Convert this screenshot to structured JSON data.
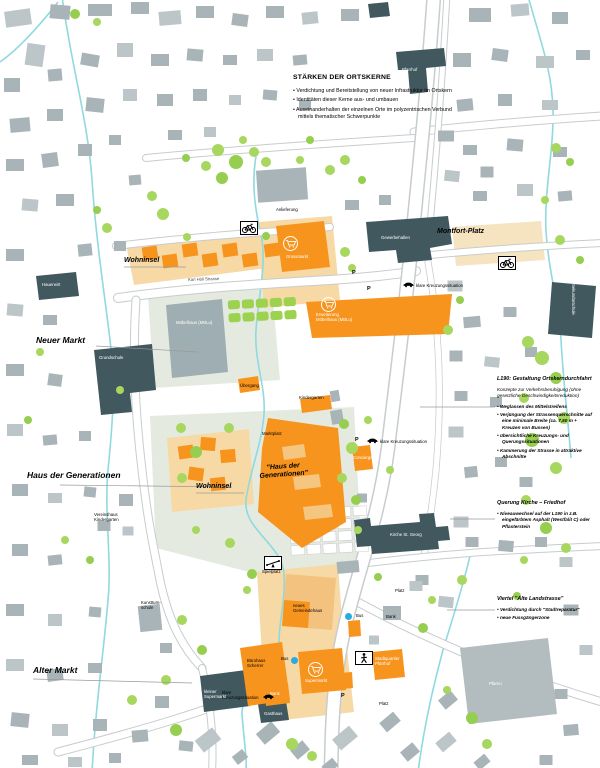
{
  "top_note": {
    "heading": "STÄRKEN DER ORTSKERNE",
    "bullets": [
      "Verdichtung und Bereitstellung von neuer Infrastruktur im Ortskern",
      "Identitäten dieser Kerne aus- und umbauen",
      "Auseinanderhalten der einzelnen Orte im polyzentrischen Verbund mittels thematischer Schwerpunkte"
    ]
  },
  "side_notes": {
    "l190": {
      "heading": "L190: Gestaltung Ortskerndurchfahrt",
      "intro": "Konzepte zur Verkehrsberuhigung (ohne gesetzliche Geschwindigkeitsreduktion)",
      "bullets": [
        "Weglassen des Mittelstreifens",
        "Verjüngung der Strassenquerschnitte auf eine minimale Breite (ca. 7,50 m + Kreuzen von Bussen)",
        "übersichtliche Kreuzungs- und Querungssituationen",
        "Kammerung der Strasse in attraktive Abschnitte"
      ]
    },
    "querung": {
      "heading": "Querung Kirche – Friedhof",
      "bullets": [
        "Niveauwechsel auf der L190 in z.B. eingefärbtem Asphalt (Westfalit C) oder Pflasterstein"
      ]
    },
    "viertel": {
      "heading": "Viertel \"Alte Landstrasse\"",
      "bullets": [
        "Verdichtung durch \"Stadtreparatur\"",
        "neue Fussgängerzone"
      ]
    }
  },
  "map_labels": [
    {
      "n": "label-wohninsel-nord",
      "text": "Wohninsel",
      "x": 124,
      "y": 257,
      "cls": "district"
    },
    {
      "n": "label-neuer-markt",
      "text": "Neuer Markt",
      "x": 36,
      "y": 335,
      "cls": "district lg"
    },
    {
      "n": "label-haus-der-generationen",
      "text": "Haus der Generationen",
      "x": 27,
      "y": 470,
      "cls": "district lg"
    },
    {
      "n": "label-wohninsel-sued",
      "text": "Wohninsel",
      "x": 196,
      "y": 483,
      "cls": "district"
    },
    {
      "n": "label-alter-markt",
      "text": "Alter Markt",
      "x": 33,
      "y": 665,
      "cls": "district lg"
    },
    {
      "n": "label-montfort-platz",
      "text": "Montfort-Platz",
      "x": 437,
      "y": 228,
      "cls": "district"
    },
    {
      "n": "label-hdg-center",
      "text": "\"Haus der\nGenerationen\"",
      "x": 283,
      "y": 465,
      "cls": "district ctr",
      "rot": -4
    },
    {
      "n": "label-anlieferung",
      "text": "Anlieferung",
      "x": 276,
      "y": 207,
      "cls": "tiny"
    },
    {
      "n": "label-karl-holl-strasse",
      "text": "Karl Höll Strasse",
      "x": 188,
      "y": 278,
      "cls": "street",
      "rot": -2
    },
    {
      "n": "label-uebergang",
      "text": "Übergang",
      "x": 240,
      "y": 383,
      "cls": "tiny"
    },
    {
      "n": "label-kindergarten",
      "text": "Kindergarten",
      "x": 299,
      "y": 395,
      "cls": "tiny"
    },
    {
      "n": "label-marktplatz",
      "text": "Marktplatz",
      "x": 262,
      "y": 431,
      "cls": "tiny"
    },
    {
      "n": "label-kreuzung-1",
      "text": "klare Kreuzungssituation",
      "x": 416,
      "y": 283,
      "cls": "tiny"
    },
    {
      "n": "label-kreuzung-2",
      "text": "klare Kreuzungssituation",
      "x": 380,
      "y": 439,
      "cls": "tiny"
    },
    {
      "n": "label-kreuzung-3",
      "text": "klare\nKreuzungssituation",
      "x": 222,
      "y": 690,
      "cls": "tiny"
    },
    {
      "n": "label-spielplatz",
      "text": "Spielplatz",
      "x": 262,
      "y": 569,
      "cls": "tiny"
    },
    {
      "n": "label-vereinshaus",
      "text": "Vereinshaus\nKindergarten",
      "x": 94,
      "y": 512,
      "cls": "tiny"
    },
    {
      "n": "label-kunstturnschule",
      "text": "Kunstturn-\nschule",
      "x": 141,
      "y": 600,
      "cls": "tiny"
    },
    {
      "n": "label-bus-1",
      "text": "Bus",
      "x": 356,
      "y": 613,
      "cls": "tiny"
    },
    {
      "n": "label-bus-2",
      "text": "Bus",
      "x": 281,
      "y": 656,
      "cls": "tiny"
    },
    {
      "n": "label-platz-1",
      "text": "Platz",
      "x": 395,
      "y": 588,
      "cls": "tiny"
    },
    {
      "n": "label-platz-2",
      "text": "Platz",
      "x": 379,
      "y": 701,
      "cls": "tiny"
    },
    {
      "n": "label-bank-grau",
      "text": "Bank",
      "x": 386,
      "y": 614,
      "cls": "tiny"
    },
    {
      "n": "label-gemeindehaus",
      "text": "neues\nGemeindehaus",
      "x": 293,
      "y": 603,
      "cls": "tiny"
    },
    {
      "n": "label-buerohaus",
      "text": "Bürohaus\nScherrer",
      "x": 247,
      "y": 658,
      "cls": "tiny"
    },
    {
      "n": "label-kirche",
      "text": "Kirche St. Georg",
      "x": 390,
      "y": 532,
      "cls": "twhite"
    },
    {
      "n": "label-grundschule",
      "text": "Grundschule",
      "x": 99,
      "y": 355,
      "cls": "twhite"
    },
    {
      "n": "label-hauerwirt",
      "text": "Hauerwirt",
      "x": 42,
      "y": 282,
      "cls": "twhite"
    },
    {
      "n": "label-gewerbehallen",
      "text": "Gewerbehallen",
      "x": 381,
      "y": 235,
      "cls": "twhite"
    },
    {
      "n": "label-moebelhaus",
      "text": "Möbelhaus (MBLu)",
      "x": 176,
      "y": 320,
      "cls": "twhite"
    },
    {
      "n": "label-erweiterung-moebelhaus",
      "text": "Erweiterung\nMöbelhaus (MBLu)",
      "x": 316,
      "y": 312,
      "cls": "twhite"
    },
    {
      "n": "label-grossmarkt",
      "text": "Grossmarkt",
      "x": 286,
      "y": 254,
      "cls": "twhite"
    },
    {
      "n": "label-supermarkt",
      "text": "Supermarkt",
      "x": 305,
      "y": 678,
      "cls": "twhite"
    },
    {
      "n": "label-bank-orange",
      "text": "Bank",
      "x": 270,
      "y": 691,
      "cls": "twhite"
    },
    {
      "n": "label-concierge",
      "text": "Concierge",
      "x": 353,
      "y": 455,
      "cls": "twhite"
    },
    {
      "n": "label-stadtquartier",
      "text": "Stadtquartier\nPfarrhof",
      "x": 375,
      "y": 656,
      "cls": "twhite"
    },
    {
      "n": "label-kleiner-supermarkt",
      "text": "kleiner\nSupermarkt",
      "x": 204,
      "y": 689,
      "cls": "twhite"
    },
    {
      "n": "label-gasthaus",
      "text": "Gasthaus",
      "x": 264,
      "y": 711,
      "cls": "twhite"
    },
    {
      "n": "label-pfarrei",
      "text": "Pfarrei",
      "x": 489,
      "y": 681,
      "cls": "twhite"
    },
    {
      "n": "label-sekundarschule",
      "text": "Sekundarschule",
      "x": 576,
      "y": 284,
      "cls": "twhite",
      "rot": 90
    },
    {
      "n": "label-pfarrhof-top",
      "text": "Pfarrhof",
      "x": 402,
      "y": 67,
      "cls": "twhite"
    },
    {
      "n": "parking-marker",
      "text": "P",
      "x": 352,
      "y": 270,
      "cls": "pmark"
    },
    {
      "n": "parking-marker",
      "text": "P",
      "x": 367,
      "y": 286,
      "cls": "pmark"
    },
    {
      "n": "parking-marker",
      "text": "P",
      "x": 355,
      "y": 437,
      "cls": "pmark"
    },
    {
      "n": "parking-marker",
      "text": "P",
      "x": 341,
      "y": 693,
      "cls": "pmark"
    }
  ],
  "markers": {
    "icon_boxes": [
      {
        "n": "bicycle-icon",
        "icon": "bike",
        "x": 240,
        "y": 221,
        "box": "rect"
      },
      {
        "n": "bicycle-icon",
        "icon": "bike",
        "x": 498,
        "y": 256,
        "box": "rect"
      },
      {
        "n": "pedestrian-icon",
        "icon": "ped",
        "x": 355,
        "y": 651,
        "box": "rect"
      },
      {
        "n": "playground-icon",
        "icon": "seesaw",
        "x": 264,
        "y": 556,
        "box": "rect"
      },
      {
        "n": "car-icon",
        "icon": "car",
        "x": 403,
        "y": 280,
        "box": "plain"
      },
      {
        "n": "car-icon",
        "icon": "car",
        "x": 367,
        "y": 436,
        "box": "plain"
      },
      {
        "n": "car-icon",
        "icon": "car",
        "x": 263,
        "y": 692,
        "box": "plain"
      },
      {
        "n": "cart-icon",
        "icon": "cart",
        "x": 283,
        "y": 236,
        "box": "circle"
      },
      {
        "n": "cart-icon",
        "icon": "cart",
        "x": 321,
        "y": 297,
        "box": "circle"
      },
      {
        "n": "cart-icon",
        "icon": "cart",
        "x": 308,
        "y": 662,
        "box": "circle"
      }
    ],
    "bus_stops": [
      {
        "x": 348,
        "y": 616
      },
      {
        "x": 294,
        "y": 660
      }
    ],
    "bus_color": "#29ABE2"
  },
  "colors": {
    "orange": "#F7941E",
    "tan_building": "#F4C67F",
    "tan_area": "#F7D9A5",
    "gray_building": "#A9B4B8",
    "dark_building": "#40585E",
    "park": "#E5EAE1",
    "tree": "#A5D65C",
    "stream": "#8FD9DF",
    "bus_dot": "#29ABE2"
  }
}
